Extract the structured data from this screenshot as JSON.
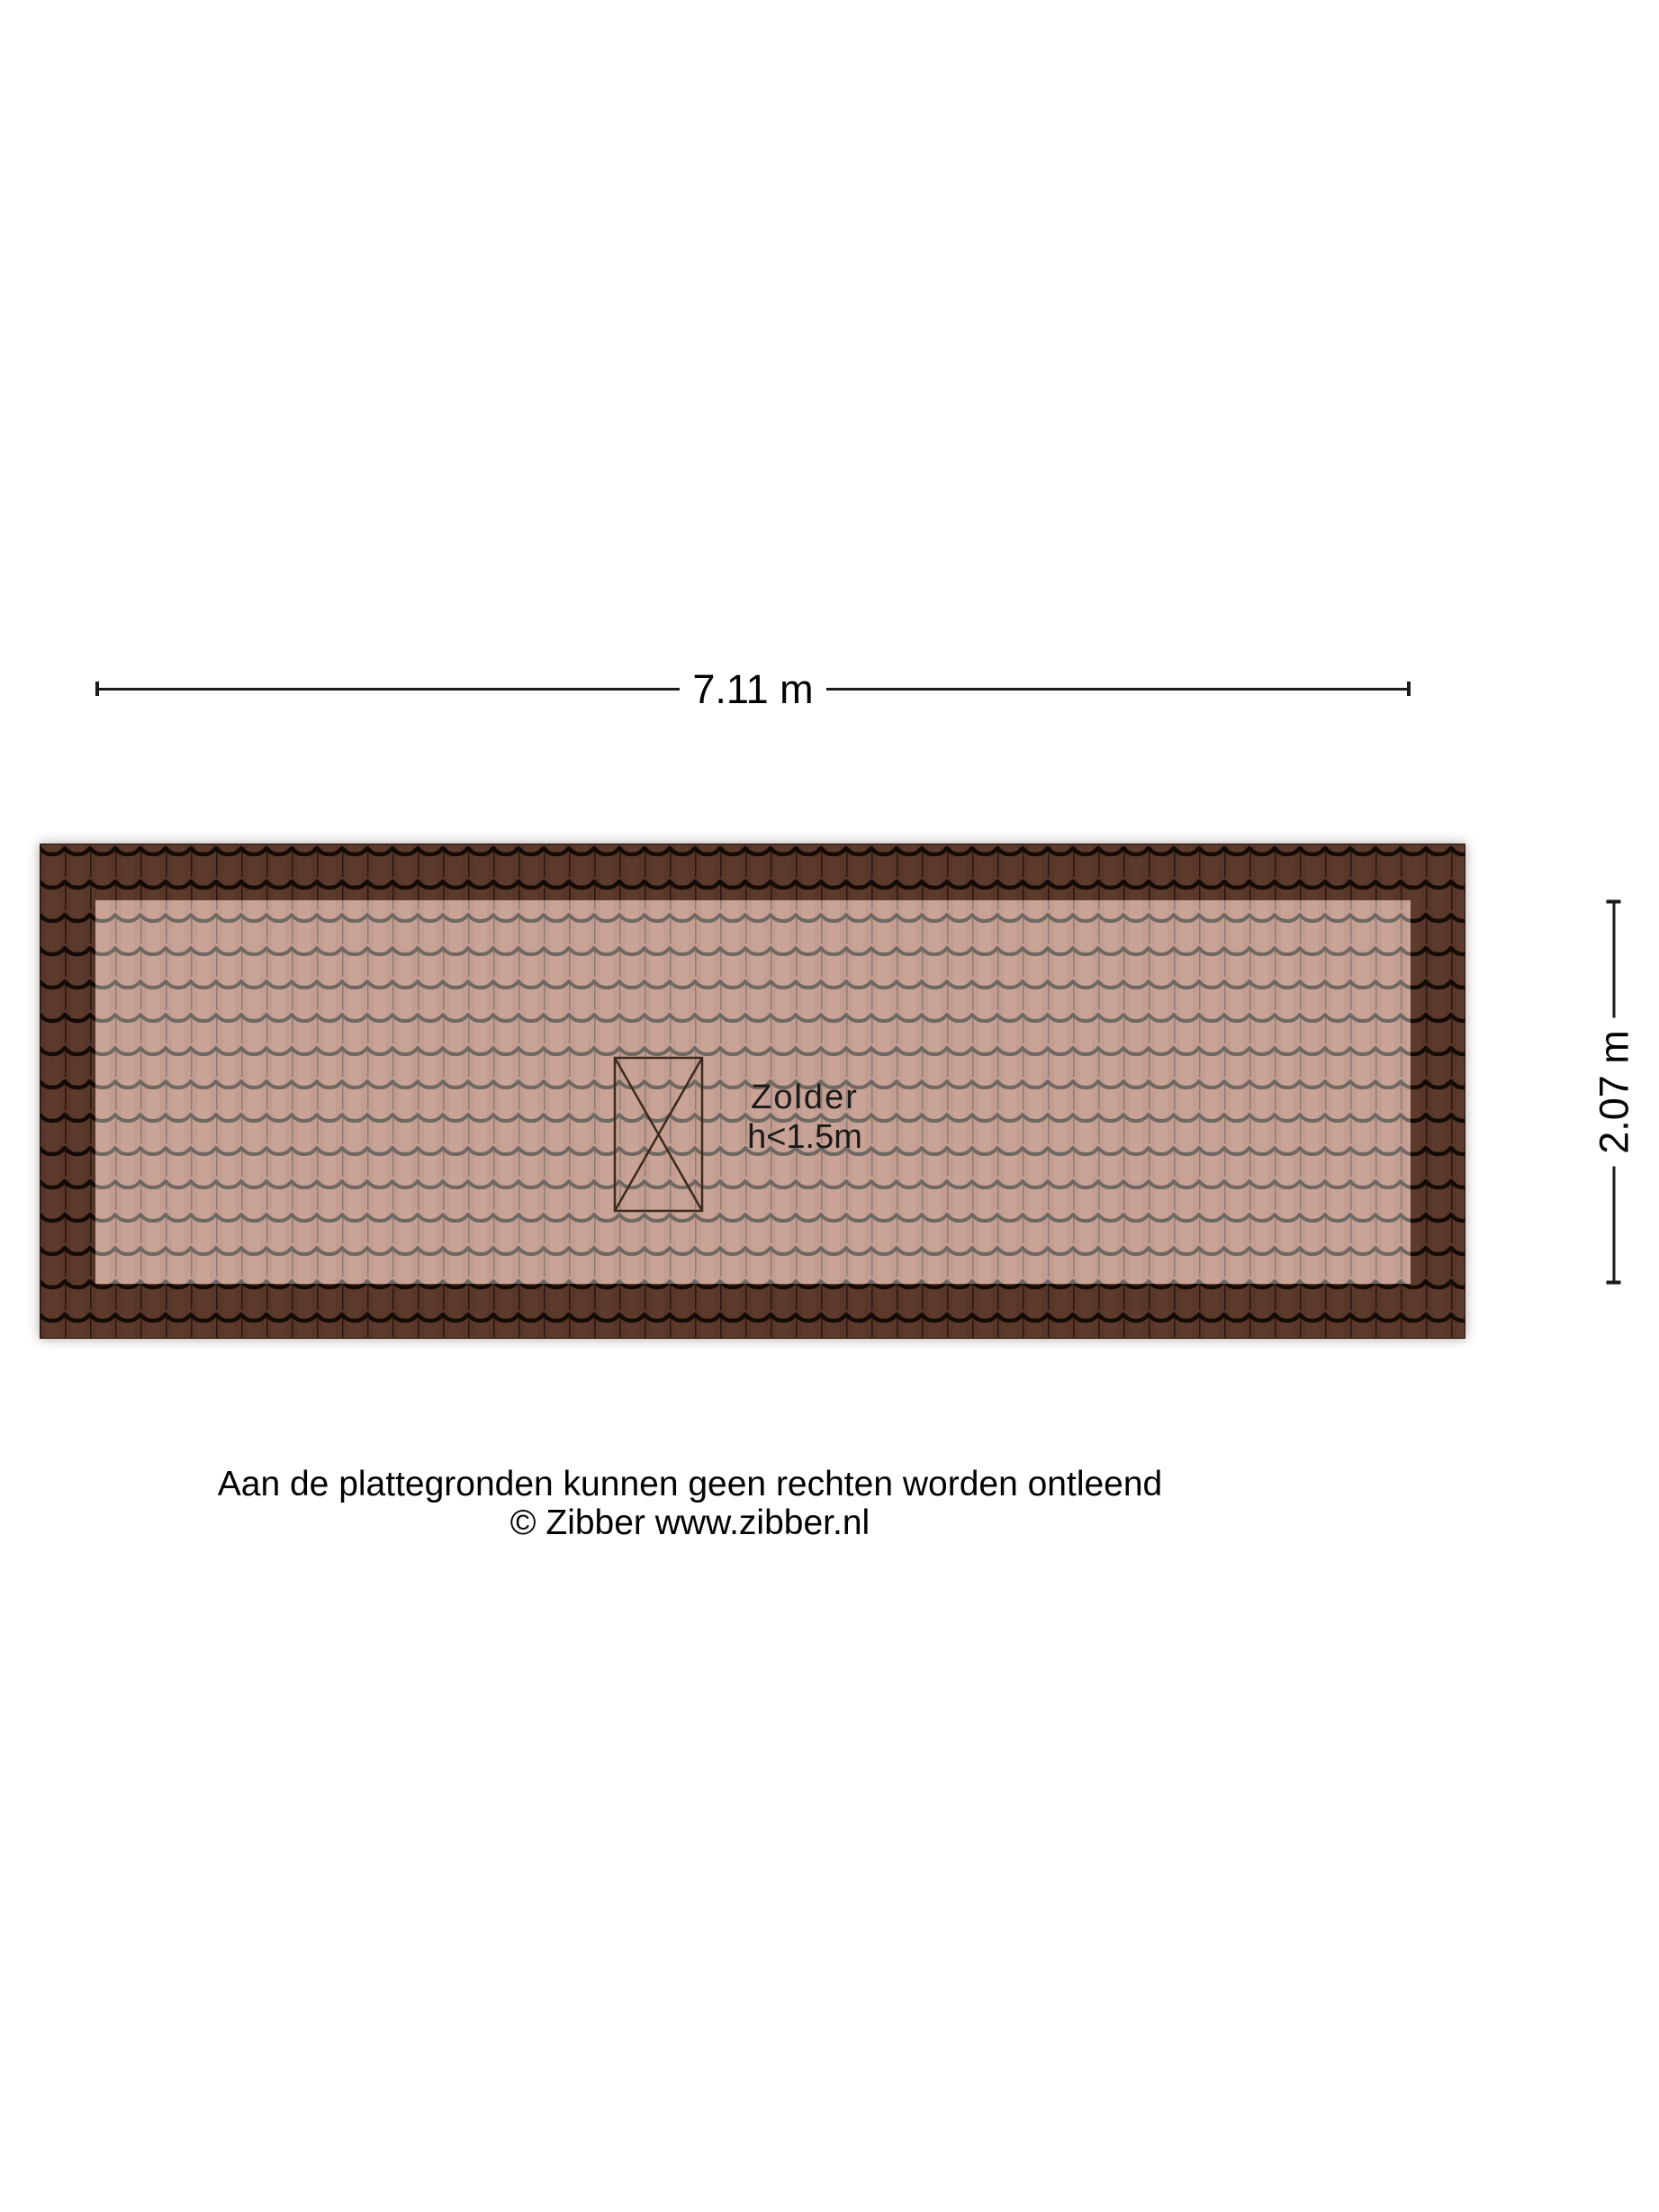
{
  "dimensions": {
    "width_label": "7.11 m",
    "height_label": "2.07 m"
  },
  "room": {
    "name": "Zolder",
    "height_note": "h<1.5m"
  },
  "footer": {
    "disclaimer": "Aan de plattegronden kunnen geen rechten worden ontleend",
    "copyright": "© Zibber www.zibber.nl"
  },
  "colors": {
    "roof_dark_tile": "#583629",
    "roof_dark_groove": "#140a06",
    "roof_dark_joint": "#2a1710",
    "roof_light_tile": "#c39d91",
    "roof_light_groove": "#6f6862",
    "roof_light_joint": "#8d7d74",
    "skylight_stroke": "#3c2a1d",
    "dimension_line": "#1a1a1a",
    "text": "#000000"
  }
}
